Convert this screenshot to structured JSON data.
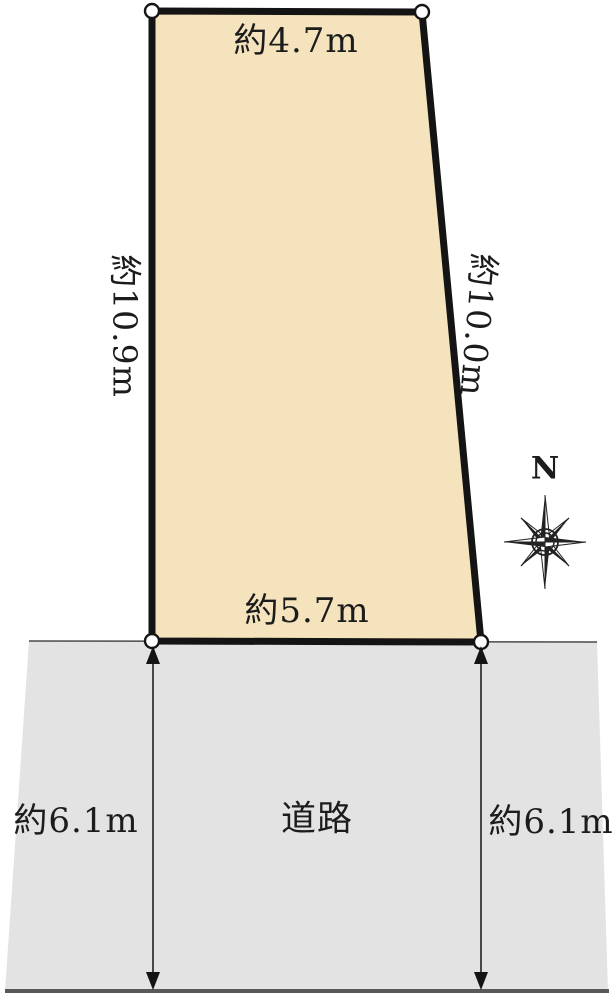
{
  "plot": {
    "fill": "#f4e3bc",
    "top_label": "約4.7m",
    "left_label": "約10.9m",
    "right_label": "約10.0m",
    "bottom_label": "約5.7m"
  },
  "road": {
    "fill": "#e3e3e3",
    "label": "道路",
    "left_dimension": "約6.1m",
    "right_dimension": "約6.1m"
  },
  "compass": {
    "north_label": "N"
  },
  "colors": {
    "plot_border": "#141414",
    "road_edge": "#4a4a4a",
    "text": "#1c1c1c"
  }
}
